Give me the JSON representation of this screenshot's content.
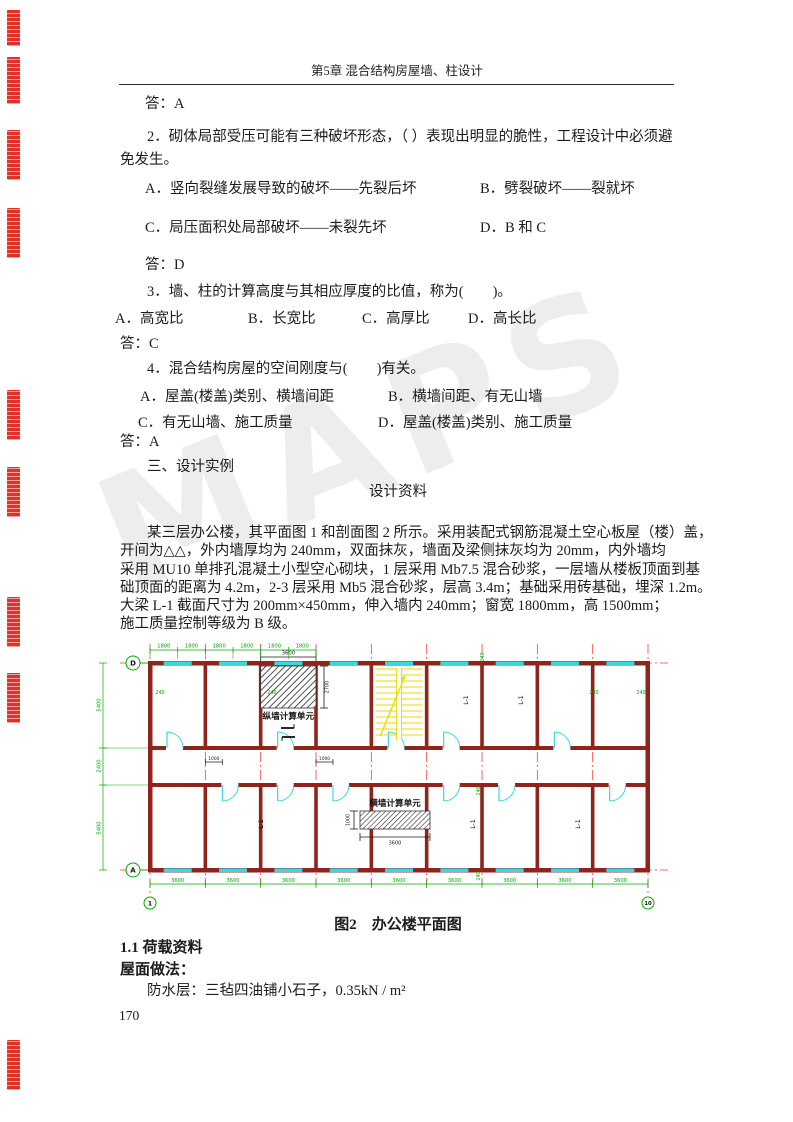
{
  "page": {
    "header_title": "第5章  混合结构房屋墙、柱设计",
    "page_number": "170",
    "watermark": "MAPS"
  },
  "questions": {
    "ans1": "答：A",
    "q2_line1": "2．砌体局部受压可能有三种破坏形态，（  ）表现出明显的脆性，工程设计中必须避",
    "q2_line2": "免发生。",
    "q2a": "A．竖向裂缝发展导致的破坏——先裂后坏",
    "q2b": "B．劈裂破坏——裂就坏",
    "q2c": "C．局压面积处局部破坏——未裂先坏",
    "q2d": "D．B 和 C",
    "ans2": "答：D",
    "q3": "3．墙、柱的计算高度与其相应厚度的比值，称为(　　)。",
    "q3a": "A．高宽比",
    "q3b": "B．长宽比",
    "q3c": "C．高厚比",
    "q3d": "D．高长比",
    "ans3": "答：C",
    "q4": "4．混合结构房屋的空间刚度与(　　)有关。",
    "q4a": "A．屋盖(楼盖)类别、横墙间距",
    "q4b": "B．横墙间距、有无山墙",
    "q4c": "C．有无山墙、施工质量",
    "q4d": "D．屋盖(楼盖)类别、施工质量",
    "ans4": "答：A",
    "section3": "三、设计实例"
  },
  "design": {
    "heading": "设计资料",
    "p1": "某三层办公楼，其平面图 1 和剖面图 2 所示。采用装配式钢筋混凝土空心板屋（楼）盖，",
    "p2": "开间为△△，外内墙厚均为 240mm，双面抹灰，墙面及梁侧抹灰均为 20mm，内外墙均",
    "p3": "采用 MU10 单排孔混凝土小型空心砌块，1 层采用 Mb7.5 混合砂浆，一层墙从楼板顶面到基",
    "p4": "础顶面的距离为 4.2m，2-3 层采用 Mb5 混合砂浆，层高 3.4m；基础采用砖基础，埋深 1.2m。",
    "p5": "大梁 L-1 截面尺寸为 200mm×450mm，伸入墙内 240mm；窗宽 1800mm，高 1500mm；",
    "p6": "施工质量控制等级为 B 级。"
  },
  "figure": {
    "caption": "图2　办公楼平面图",
    "labels": {
      "unit_longitudinal": "纵墙计算单元",
      "unit_transverse": "横墙计算单元",
      "beam": "L-1",
      "grid_d": "D",
      "grid_a": "A",
      "grid_1": "1",
      "grid_10": "10"
    },
    "dims": {
      "window": "1800",
      "bay": "3600",
      "room_depth": "5400",
      "corridor": "2400",
      "wall": "240",
      "door_offset": "1000",
      "unit_height": "2700",
      "trans_unit_height": "1000"
    },
    "top_dims": [
      "1800",
      "1800",
      "1800",
      "1800",
      "1800",
      "1800"
    ],
    "bottom_dims": [
      "3600",
      "3600",
      "3600",
      "3600",
      "3600",
      "3600",
      "3600",
      "3600",
      "3600"
    ],
    "left_dims": [
      "5400",
      "2400",
      "5400"
    ],
    "colors": {
      "grid_red": "#f5403a",
      "dim_green": "#00aa00",
      "wall": "#8f241b",
      "window_cyan": "#38d8e0",
      "stair_yellow": "#e8da00",
      "stamp_red": "#e23128",
      "hatch_dark": "#1a1a1a"
    }
  },
  "loads": {
    "sec11": "1.1 荷载资料",
    "roof_heading": "屋面做法：",
    "waterproof": "防水层：三毡四油铺小石子，0.35kN / m²"
  }
}
